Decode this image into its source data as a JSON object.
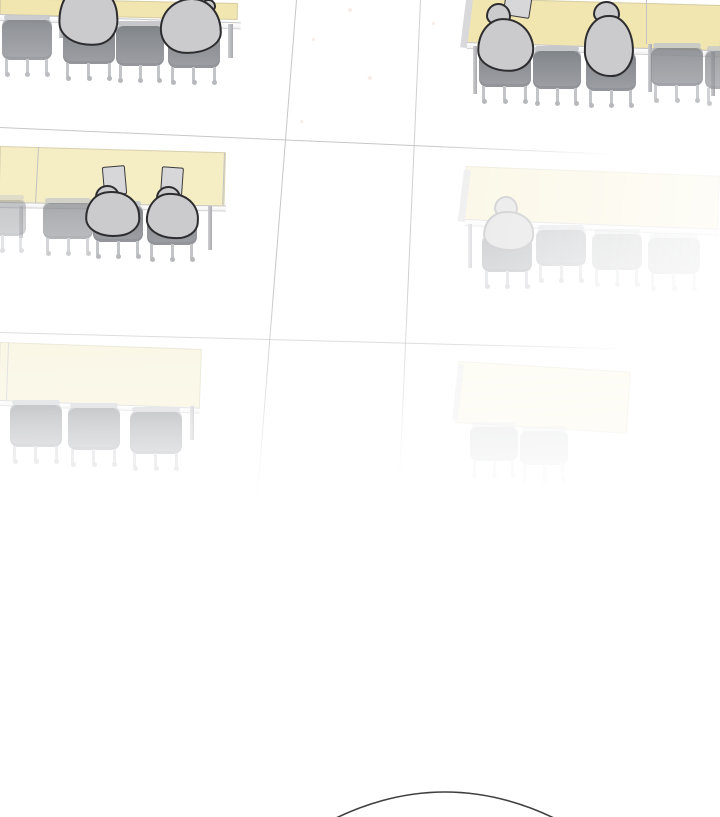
{
  "scene": {
    "colors": {
      "background": "#FFFFFF",
      "y1": "#F1E6B0",
      "y2": "#F5EDC4",
      "y3": "#F5EFCE",
      "chair_gray": "#8A8D92",
      "figure_fill": "#CBCBCD",
      "figure_outline": "#2D2D2F",
      "floor_line": "#C7C7C9",
      "arc_stroke": "#3F3F3F"
    },
    "arc": {
      "x1": 334,
      "y1": 819,
      "cx": 445,
      "cy": 765,
      "x2": 556,
      "y2": 819
    },
    "layers": [
      {
        "name": "floor-lines",
        "cls": "",
        "els": [
          {
            "t": "hline",
            "name": "floor-line-row1",
            "x": 0,
            "y": 127,
            "w": 615,
            "h": 1.3,
            "rot": 2.5
          },
          {
            "t": "hline",
            "name": "floor-line-row2",
            "x": 0,
            "y": 332,
            "w": 635,
            "h": 1.3,
            "rot": 1.5,
            "op": 0.6
          },
          {
            "t": "vline",
            "name": "aisle-line-left",
            "x": 296,
            "y": 0,
            "w": 1.3,
            "h": 530,
            "rot": 4.5
          },
          {
            "t": "vline",
            "name": "aisle-line-right",
            "x": 420,
            "y": 0,
            "w": 1.3,
            "h": 505,
            "rot": 2.5,
            "op": 0.85
          }
        ]
      },
      {
        "name": "desk-group-row1-left",
        "cls": "",
        "els": [
          {
            "t": "desk",
            "name": "desk-row1-left",
            "x": 0,
            "y": -2,
            "w": 238,
            "h": 17,
            "rot": 1.2,
            "bg": "y1"
          },
          {
            "t": "front",
            "name": "desk-front-edge",
            "x": 0,
            "y": 14,
            "w": 241,
            "h": 7,
            "rot": 2
          },
          {
            "t": "leg",
            "name": "desk-leg",
            "x": 59,
            "y": 19,
            "w": 4,
            "h": 19
          },
          {
            "t": "leg",
            "name": "desk-leg",
            "x": 228,
            "y": 24,
            "w": 5,
            "h": 34
          },
          {
            "t": "chair",
            "name": "chair-empty",
            "x": 2,
            "y": 18,
            "w": 50,
            "h": 42,
            "op": 0.9
          },
          {
            "t": "chair",
            "name": "chair-occupied",
            "x": 63,
            "y": 22,
            "w": 52,
            "h": 42
          },
          {
            "t": "chair",
            "name": "chair-empty",
            "x": 116,
            "y": 24,
            "w": 48,
            "h": 42
          },
          {
            "t": "chair",
            "name": "chair-occupied",
            "x": 168,
            "y": 26,
            "w": 52,
            "h": 42
          },
          {
            "t": "body",
            "name": "student-figure",
            "x": 58,
            "y": -16,
            "w": 60,
            "h": 62,
            "rot": -4,
            "r": "48% 52% 40% 60% / 64% 54% 42% 40%"
          },
          {
            "t": "head",
            "name": "student-head",
            "x": 183,
            "y": -8,
            "w": 26,
            "h": 20
          },
          {
            "t": "head",
            "name": "student-hand",
            "x": 201,
            "y": -1,
            "w": 15,
            "h": 13
          },
          {
            "t": "body",
            "name": "student-figure",
            "x": 160,
            "y": -2,
            "w": 62,
            "h": 56,
            "rot": 2,
            "r": "52% 48% 58% 42% / 56% 62% 40% 44%"
          }
        ]
      },
      {
        "name": "desk-group-row1-right",
        "cls": "",
        "els": [
          {
            "t": "desk",
            "name": "desk-row1-right",
            "x": 468,
            "y": -2,
            "w": 254,
            "h": 46,
            "rot": 1.6,
            "bg": "y1"
          },
          {
            "t": "end",
            "name": "desk-end-panel",
            "x": 466,
            "y": 0,
            "w": 7,
            "h": 48,
            "rot": 7
          },
          {
            "t": "seam",
            "name": "desk-seam",
            "x": 646,
            "y": 0,
            "w": 1.4,
            "h": 44
          },
          {
            "t": "front",
            "name": "desk-front-edge",
            "x": 467,
            "y": 42,
            "w": 253,
            "h": 7,
            "rot": 1.9
          },
          {
            "t": "leg",
            "name": "desk-leg",
            "x": 473,
            "y": 46,
            "w": 4,
            "h": 48
          },
          {
            "t": "leg",
            "name": "desk-leg",
            "x": 648,
            "y": 44,
            "w": 4,
            "h": 48
          },
          {
            "t": "leg",
            "name": "desk-leg",
            "x": 711,
            "y": 52,
            "w": 4,
            "h": 44
          },
          {
            "t": "chair",
            "name": "chair-occupied",
            "x": 479,
            "y": 47,
            "w": 52,
            "h": 40
          },
          {
            "t": "chair",
            "name": "chair-empty",
            "x": 533,
            "y": 49,
            "w": 48,
            "h": 40
          },
          {
            "t": "chair",
            "name": "chair-occupied",
            "x": 586,
            "y": 51,
            "w": 50,
            "h": 40
          },
          {
            "t": "chair",
            "name": "chair-empty",
            "x": 651,
            "y": 46,
            "w": 52,
            "h": 40,
            "op": 0.85
          },
          {
            "t": "chair",
            "name": "chair-empty",
            "x": 705,
            "y": 49,
            "w": 40,
            "h": 40,
            "op": 0.75
          },
          {
            "t": "paper",
            "name": "paper-sheet",
            "x": 504,
            "y": -5,
            "w": 27,
            "h": 22,
            "rot": 9
          },
          {
            "t": "head",
            "name": "student-head",
            "x": 486,
            "y": 3,
            "w": 25,
            "h": 23
          },
          {
            "t": "body",
            "name": "student-figure",
            "x": 477,
            "y": 18,
            "w": 57,
            "h": 54,
            "rot": -3,
            "r": "46% 54% 42% 58% / 60% 58% 42% 40%"
          },
          {
            "t": "head",
            "name": "student-head",
            "x": 593,
            "y": 1,
            "w": 27,
            "h": 23
          },
          {
            "t": "body",
            "name": "student-figure",
            "x": 584,
            "y": 15,
            "w": 50,
            "h": 62,
            "rot": 1,
            "r": "50% 50% 46% 54% / 52% 60% 44% 42%"
          }
        ]
      },
      {
        "name": "desk-group-row2-left",
        "cls": "",
        "els": [
          {
            "t": "desk",
            "name": "desk-row2-left",
            "x": 0,
            "y": 146,
            "w": 226,
            "h": 58,
            "rot": 1.6,
            "bg": "y2"
          },
          {
            "t": "seam",
            "name": "desk-seam",
            "x": 38,
            "y": 147,
            "w": 1.3,
            "h": 56,
            "rot": 3
          },
          {
            "t": "seam",
            "name": "desk-end-line",
            "x": 224,
            "y": 153,
            "w": 1.3,
            "h": 52,
            "rot": 2
          },
          {
            "t": "front",
            "name": "desk-front-edge",
            "x": 0,
            "y": 202,
            "w": 226,
            "h": 6,
            "rot": 0.9
          },
          {
            "t": "leg",
            "name": "desk-leg",
            "x": 19,
            "y": 206,
            "w": 4,
            "h": 32,
            "op": 0.6
          },
          {
            "t": "leg",
            "name": "desk-leg",
            "x": 208,
            "y": 206,
            "w": 4,
            "h": 44
          },
          {
            "t": "chair",
            "name": "chair-empty",
            "x": -22,
            "y": 198,
            "w": 48,
            "h": 38,
            "op": 0.45
          },
          {
            "t": "chair",
            "name": "chair-empty",
            "x": 43,
            "y": 201,
            "w": 50,
            "h": 38,
            "op": 0.7
          },
          {
            "t": "chair",
            "name": "chair-occupied",
            "x": 93,
            "y": 204,
            "w": 50,
            "h": 38
          },
          {
            "t": "chair",
            "name": "chair-occupied",
            "x": 147,
            "y": 207,
            "w": 50,
            "h": 38
          },
          {
            "t": "paper",
            "name": "paper-sheet",
            "x": 103,
            "y": 166,
            "w": 23,
            "h": 29,
            "rot": -5
          },
          {
            "t": "head",
            "name": "student-head",
            "x": 95,
            "y": 185,
            "w": 25,
            "h": 21
          },
          {
            "t": "body",
            "name": "student-figure",
            "x": 85,
            "y": 191,
            "w": 55,
            "h": 46,
            "rot": -3
          },
          {
            "t": "paper",
            "name": "paper-sheet",
            "x": 161,
            "y": 167,
            "w": 22,
            "h": 28,
            "rot": 4
          },
          {
            "t": "head",
            "name": "student-head",
            "x": 156,
            "y": 186,
            "w": 25,
            "h": 21
          },
          {
            "t": "body",
            "name": "student-figure",
            "x": 146,
            "y": 193,
            "w": 53,
            "h": 46,
            "rot": 2
          }
        ]
      },
      {
        "name": "desk-group-row2-right",
        "cls": "layer-fade-right",
        "els": [
          {
            "t": "desk",
            "name": "desk-row2-right",
            "x": 466,
            "y": 166,
            "w": 254,
            "h": 56,
            "rot": 2.2,
            "bg": "y2"
          },
          {
            "t": "end",
            "name": "desk-end-panel",
            "x": 464,
            "y": 170,
            "w": 7,
            "h": 52,
            "rot": 7
          },
          {
            "t": "front",
            "name": "desk-front-edge",
            "x": 465,
            "y": 219,
            "w": 254,
            "h": 7,
            "rot": 2.2
          },
          {
            "t": "leg",
            "name": "desk-leg",
            "x": 468,
            "y": 224,
            "w": 4,
            "h": 44
          },
          {
            "t": "chair",
            "name": "chair-occupied",
            "x": 482,
            "y": 234,
            "w": 50,
            "h": 38
          },
          {
            "t": "chair",
            "name": "chair-empty",
            "x": 536,
            "y": 228,
            "w": 50,
            "h": 38,
            "op": 0.8
          },
          {
            "t": "chair",
            "name": "chair-empty",
            "x": 592,
            "y": 232,
            "w": 50,
            "h": 38,
            "op": 0.6
          },
          {
            "t": "chair",
            "name": "chair-empty",
            "x": 648,
            "y": 236,
            "w": 52,
            "h": 38,
            "op": 0.5
          },
          {
            "t": "head",
            "name": "student-head",
            "x": 494,
            "y": 196,
            "w": 24,
            "h": 22
          },
          {
            "t": "body",
            "name": "student-figure",
            "x": 483,
            "y": 211,
            "w": 51,
            "h": 40,
            "rot": -2
          }
        ]
      },
      {
        "name": "desk-group-row3-left",
        "cls": "layer-fade-down",
        "els": [
          {
            "t": "desk",
            "name": "desk-row3-left",
            "x": 0,
            "y": 342,
            "w": 202,
            "h": 60,
            "rot": 2,
            "bg": "y3"
          },
          {
            "t": "seam",
            "name": "desk-seam",
            "x": 8,
            "y": 343,
            "w": 1.3,
            "h": 58,
            "rot": 2
          },
          {
            "t": "front",
            "name": "desk-front-edge",
            "x": 0,
            "y": 400,
            "w": 200,
            "h": 6,
            "rot": 2.2
          },
          {
            "t": "leg",
            "name": "desk-leg",
            "x": 190,
            "y": 406,
            "w": 4,
            "h": 34
          },
          {
            "t": "chair",
            "name": "chair-empty",
            "x": 10,
            "y": 403,
            "w": 52,
            "h": 44
          },
          {
            "t": "chair",
            "name": "chair-empty",
            "x": 68,
            "y": 406,
            "w": 52,
            "h": 44
          },
          {
            "t": "chair",
            "name": "chair-empty",
            "x": 130,
            "y": 410,
            "w": 52,
            "h": 44
          }
        ]
      },
      {
        "name": "desk-group-row3-right",
        "cls": "layer-ghost",
        "els": [
          {
            "t": "desk",
            "name": "desk-row3-right",
            "x": 459,
            "y": 361,
            "w": 172,
            "h": 62,
            "rot": 3.6,
            "bg": "y3"
          },
          {
            "t": "end",
            "name": "desk-end-panel",
            "x": 458,
            "y": 364,
            "w": 6,
            "h": 56,
            "rot": 6
          },
          {
            "t": "chair",
            "name": "chair-empty",
            "x": 470,
            "y": 425,
            "w": 48,
            "h": 36,
            "op": 0.6
          },
          {
            "t": "chair",
            "name": "chair-empty",
            "x": 520,
            "y": 429,
            "w": 48,
            "h": 36,
            "op": 0.5
          }
        ]
      },
      {
        "name": "dust-specks",
        "cls": "",
        "els": [
          {
            "t": "speck",
            "name": "dust-speck",
            "x": 348,
            "y": 8,
            "w": 4,
            "h": 4
          },
          {
            "t": "speck",
            "name": "dust-speck",
            "x": 312,
            "y": 38,
            "w": 3,
            "h": 3
          },
          {
            "t": "speck",
            "name": "dust-speck",
            "x": 368,
            "y": 76,
            "w": 4,
            "h": 4
          },
          {
            "t": "speck",
            "name": "dust-speck",
            "x": 300,
            "y": 120,
            "w": 3,
            "h": 3
          },
          {
            "t": "speck",
            "name": "dust-speck",
            "x": 432,
            "y": 22,
            "w": 3,
            "h": 3
          }
        ]
      }
    ]
  }
}
